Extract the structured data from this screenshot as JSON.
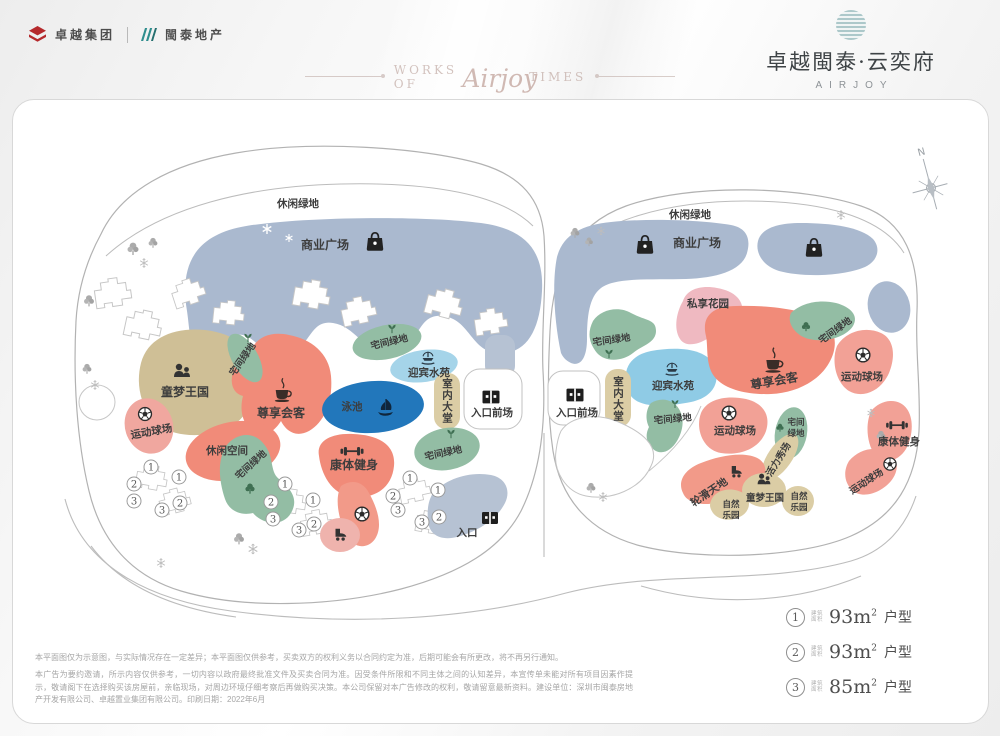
{
  "header": {
    "logo_group": "卓越集团",
    "logo_partner": "閩泰地产",
    "watermark_left": "WORKS OF",
    "watermark_script": "Airjoy",
    "watermark_right": "TIMES",
    "brand_title": "卓越閩泰·云奕府",
    "brand_subtitle": "AIRJOY"
  },
  "compass": {
    "north_label": "N"
  },
  "areas": {
    "leisure_green": "休闲绿地",
    "commercial_plaza": "商业广场",
    "kids_kingdom": "童梦王国",
    "sports_court": "运动球场",
    "vip_lounge": "尊享会客",
    "pool": "泳池",
    "water_garden": "迎宾水苑",
    "indoor_lobby": "室内大堂",
    "entrance_forecourt": "入口前场",
    "residential_green": "宅间绿地",
    "residential_green_line1": "宅间",
    "residential_green_line2": "绿地",
    "leisure_space": "休闲空间",
    "fitness": "康体健身",
    "entrance": "入口",
    "private_garden": "私享花园",
    "vitality_stage": "活力秀场",
    "roller_skating": "轮滑天地",
    "nature_park_line1": "自然",
    "nature_park_line2": "乐园"
  },
  "building_numbers": {
    "n1": "1",
    "n2": "2",
    "n3": "3"
  },
  "legend": {
    "items": [
      {
        "num": "1",
        "area_line1": "建筑",
        "area_line2": "面积",
        "value": "93m",
        "sup": "2",
        "suffix": "户型"
      },
      {
        "num": "2",
        "area_line1": "建筑",
        "area_line2": "面积",
        "value": "93m",
        "sup": "2",
        "suffix": "户型"
      },
      {
        "num": "3",
        "area_line1": "建筑",
        "area_line2": "面积",
        "value": "85m",
        "sup": "2",
        "suffix": "户型"
      }
    ]
  },
  "disclaimer": {
    "p1": "本平面图仅为示意图，与实际情况存在一定差异；本平面图仅供参考，买卖双方的权利义务以合同约定为准，后期可能会有所更改，将不再另行通知。",
    "p2": "本广告为要约邀请，所示内容仅供参考，一切内容以政府最终批准文件及买卖合同为准。因受条件所限和不同主体之间的认知差异，本宣传单未能对所有项目因素作提示，敬请阁下在选择购买该房屋前，亲临现场，对周边环境仔细考察后再做购买决策。本公司保留对本广告修改的权利，敬请留意最新资料。建设单位：深圳市闽泰房地产开发有限公司、卓越置业集团有限公司。印刷日期：2022年6月"
  }
}
